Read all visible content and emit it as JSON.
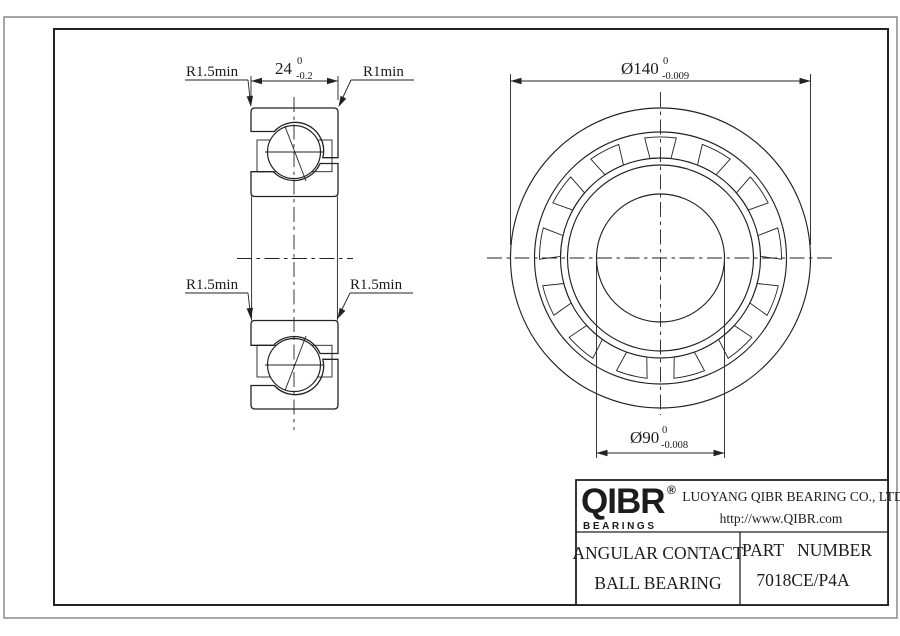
{
  "drawing": {
    "section_view": {
      "dim_width": {
        "value": "24",
        "tol_up": "0",
        "tol_dn": "-0.2"
      },
      "label_tl": "R1.5min",
      "label_tr": "R1min",
      "label_bl": "R1.5min",
      "label_br": "R1.5min"
    },
    "front_view": {
      "dim_od": {
        "value": "Ø140",
        "tol_up": "0",
        "tol_dn": "-0.009"
      },
      "dim_bore": {
        "value": "Ø90",
        "tol_up": "0",
        "tol_dn": "-0.008"
      }
    }
  },
  "title_block": {
    "brand": {
      "name": "QIBR",
      "reg": "®",
      "tagline": "BEARINGS"
    },
    "company": "LUOYANG QIBR BEARING CO., LTD",
    "website": "http://www.QIBR.com",
    "product": {
      "line1": "ANGULAR CONTACT",
      "line2": "BALL BEARING"
    },
    "part": {
      "label": "PART NUMBER",
      "number": "7018CE/P4A"
    }
  },
  "colors": {
    "line": "#222222",
    "background": "#ffffff",
    "page_border": "#8a8a8a"
  }
}
